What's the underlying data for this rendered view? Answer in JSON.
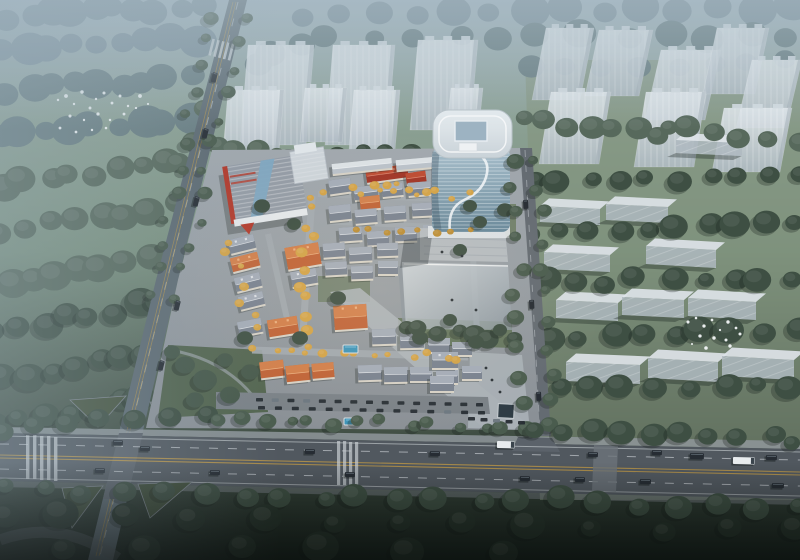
{
  "meta": {
    "title": "Aerial architectural rendering of a mixed-use development with glass office tower, low-rise villa district, ghost massing buildings, forest and road intersection",
    "render_type": "birdseye-3d-render",
    "visible_text": "none"
  },
  "palette": {
    "fogTree": "#7b8f99",
    "fogTree2": "#697e82",
    "midTree": "#57695c",
    "darkTree": "#3e4f43",
    "deepTree": "#29362d",
    "roadTree": "#4a5c4e",
    "parkTree": "#46584a",
    "autumn": "#d2a247",
    "autumn2": "#bb8c34",
    "asphalt": "#51585f",
    "asphaltLight": "#5b626a",
    "sidewalk": "#8f969b",
    "laneYellow": "#bd9747",
    "laneWhite": "#d6dbdf",
    "ghost": "#b9c3cb",
    "ghostTop": "#dde3e8",
    "ghostShade": "#9fabb4",
    "glass": "#7e9cb0",
    "glassLight": "#a9c0cd",
    "towerCap": "#dee5e9",
    "roofGray": "#78818f",
    "roofGrayLight": "#a7afbb",
    "roofOrange": "#bf6236",
    "roofOrangeLight": "#d3824d",
    "roofRed": "#a03425",
    "roofRedLight": "#bf4c33",
    "slabRoof": "#b9c1c9",
    "slabRoofLight": "#dfe4e8",
    "wall": "#d6d1c6",
    "paving": "#9ba2a9",
    "pavingLight": "#b3b9be",
    "lawn": "#66785c",
    "parkGreen": "#52644f",
    "pool": "#3c93b8",
    "carDark": "#262c33",
    "carWhite": "#e8ecee",
    "red": "#b2392a",
    "bird": "#f2f6f7",
    "shadow": "#141d19"
  },
  "scene": {
    "belts": [
      [
        10,
        16,
        200,
        6,
        10,
        15,
        "fogTree",
        "back"
      ],
      [
        0,
        52,
        198,
        40,
        9,
        15,
        "fogTree",
        "back"
      ],
      [
        8,
        92,
        190,
        76,
        9,
        14,
        "fogTree2",
        "back"
      ],
      [
        0,
        138,
        188,
        118,
        9,
        15,
        "fogTree2",
        "back"
      ],
      [
        4,
        184,
        182,
        160,
        9,
        14,
        "midTree",
        "back"
      ],
      [
        0,
        232,
        176,
        206,
        8,
        15,
        "midTree",
        "back"
      ],
      [
        8,
        282,
        168,
        256,
        8,
        14,
        "midTree",
        "back"
      ],
      [
        0,
        330,
        158,
        302,
        8,
        14,
        "darkTree",
        "back"
      ],
      [
        6,
        378,
        148,
        352,
        7,
        13,
        "darkTree",
        "back"
      ],
      [
        0,
        424,
        140,
        398,
        7,
        12,
        "darkTree",
        "back"
      ],
      [
        300,
        14,
        795,
        6,
        14,
        15,
        "fogTree",
        "back"
      ],
      [
        330,
        40,
        792,
        34,
        12,
        13,
        "fogTree2",
        "back"
      ],
      [
        252,
        66,
        298,
        40,
        3,
        12,
        "fogTree2",
        "back"
      ],
      [
        530,
        70,
        790,
        60,
        8,
        12,
        "fogTree2",
        "back"
      ],
      [
        214,
        150,
        332,
        158,
        7,
        10,
        "midTree",
        "mid"
      ],
      [
        340,
        152,
        470,
        158,
        7,
        9,
        "darkTree",
        "mid"
      ],
      [
        520,
        120,
        660,
        132,
        7,
        11,
        "midTree",
        "mid"
      ],
      [
        665,
        128,
        795,
        140,
        6,
        11,
        "midTree",
        "mid"
      ],
      [
        532,
        182,
        795,
        175,
        10,
        11,
        "darkTree",
        "mid"
      ],
      [
        536,
        232,
        795,
        224,
        10,
        12,
        "darkTree",
        "mid"
      ],
      [
        544,
        282,
        795,
        276,
        9,
        11,
        "darkTree",
        "mid"
      ],
      [
        552,
        336,
        795,
        330,
        9,
        12,
        "darkTree",
        "mid"
      ],
      [
        558,
        390,
        795,
        386,
        8,
        11,
        "darkTree",
        "mid"
      ],
      [
        205,
        108,
        198,
        138,
        2,
        10,
        "midTree",
        "mid"
      ],
      [
        400,
        330,
        508,
        338,
        7,
        9,
        "darkTree",
        "site"
      ],
      [
        312,
        196,
        303,
        344,
        11,
        5,
        "autumn",
        "site"
      ],
      [
        330,
        190,
        468,
        196,
        9,
        4,
        "autumn",
        "site"
      ],
      [
        256,
        352,
        462,
        357,
        13,
        4,
        "autumn",
        "site"
      ],
      [
        224,
        240,
        256,
        330,
        7,
        4,
        "autumn",
        "site"
      ],
      [
        352,
        228,
        468,
        234,
        8,
        4,
        "autumn2",
        "site"
      ],
      [
        368,
        184,
        430,
        188,
        5,
        4,
        "autumn",
        "site"
      ],
      [
        216,
        14,
        150,
        296,
        12,
        6,
        "roadTree",
        "front"
      ],
      [
        244,
        16,
        178,
        296,
        12,
        6,
        "roadTree",
        "front"
      ],
      [
        512,
        160,
        526,
        428,
        11,
        7,
        "roadTree",
        "front"
      ],
      [
        540,
        160,
        556,
        428,
        11,
        7,
        "roadTree",
        "front"
      ],
      [
        0,
        428,
        205,
        416,
        7,
        10,
        "darkTree",
        "front"
      ],
      [
        214,
        420,
        530,
        426,
        14,
        7,
        "roadTree",
        "front"
      ],
      [
        536,
        428,
        798,
        440,
        10,
        11,
        "darkTree",
        "front"
      ],
      [
        4,
        490,
        796,
        506,
        21,
        11,
        "darkTree",
        "front"
      ],
      [
        0,
        516,
        790,
        532,
        13,
        14,
        "deepTree",
        "front"
      ],
      [
        60,
        548,
        500,
        552,
        6,
        16,
        "deepTree",
        "front"
      ]
    ],
    "site_trees": [
      [
        262,
        206,
        8,
        "darkTree"
      ],
      [
        294,
        224,
        7,
        "darkTree"
      ],
      [
        338,
        298,
        8,
        "darkTree"
      ],
      [
        300,
        338,
        8,
        "darkTree"
      ],
      [
        245,
        338,
        8,
        "darkTree"
      ],
      [
        420,
        338,
        8,
        "darkTree"
      ],
      [
        450,
        320,
        7,
        "darkTree"
      ],
      [
        476,
        342,
        8,
        "darkTree"
      ],
      [
        500,
        330,
        7,
        "darkTree"
      ],
      [
        460,
        250,
        7,
        "darkTree"
      ],
      [
        480,
        222,
        7,
        "darkTree"
      ],
      [
        505,
        210,
        8,
        "darkTree"
      ],
      [
        470,
        206,
        7,
        "darkTree"
      ],
      [
        185,
        365,
        10,
        "parkTree"
      ],
      [
        205,
        380,
        12,
        "parkTree"
      ],
      [
        230,
        395,
        10,
        "parkTree"
      ],
      [
        195,
        400,
        9,
        "parkTree"
      ],
      [
        250,
        372,
        9,
        "parkTree"
      ],
      [
        225,
        360,
        8,
        "parkTree"
      ],
      [
        172,
        352,
        8,
        "parkTree"
      ]
    ],
    "ghost_towers": [
      [
        240,
        45,
        66,
        100,
        8
      ],
      [
        325,
        45,
        62,
        100,
        8
      ],
      [
        410,
        40,
        60,
        90,
        8
      ],
      [
        222,
        90,
        56,
        76,
        6
      ],
      [
        300,
        88,
        42,
        54,
        5
      ],
      [
        348,
        90,
        46,
        72,
        6
      ],
      [
        446,
        88,
        32,
        48,
        5
      ],
      [
        532,
        28,
        48,
        72,
        14
      ],
      [
        585,
        30,
        54,
        66,
        14
      ],
      [
        645,
        50,
        60,
        70,
        16
      ],
      [
        703,
        28,
        52,
        66,
        14
      ],
      [
        736,
        60,
        50,
        68,
        16
      ],
      [
        539,
        92,
        60,
        72,
        12
      ],
      [
        634,
        92,
        60,
        75,
        12
      ],
      [
        712,
        108,
        68,
        64,
        12
      ]
    ],
    "ghost_slabs": [
      [
        540,
        206,
        60,
        16,
        3,
        9
      ],
      [
        606,
        204,
        62,
        16,
        3,
        9
      ],
      [
        544,
        252,
        66,
        17,
        3,
        9
      ],
      [
        646,
        246,
        70,
        18,
        4,
        9
      ],
      [
        556,
        300,
        62,
        18,
        3,
        10
      ],
      [
        622,
        297,
        62,
        18,
        3,
        10
      ],
      [
        688,
        298,
        68,
        18,
        4,
        10
      ],
      [
        566,
        362,
        74,
        19,
        3,
        10
      ],
      [
        648,
        358,
        70,
        20,
        4,
        10
      ],
      [
        722,
        356,
        72,
        20,
        4,
        10
      ],
      [
        676,
        140,
        66,
        13,
        3,
        8
      ]
    ],
    "villas": [
      [
        366,
        167,
        42,
        13,
        -8,
        "r"
      ],
      [
        406,
        172,
        20,
        11,
        -8,
        "r"
      ],
      [
        332,
        161,
        60,
        10,
        -6,
        "s"
      ],
      [
        396,
        158,
        52,
        10,
        -5,
        "s"
      ],
      [
        329,
        179,
        22,
        14,
        -8,
        "g"
      ],
      [
        354,
        186,
        24,
        13,
        -7,
        "g"
      ],
      [
        382,
        184,
        21,
        12,
        -6,
        "g"
      ],
      [
        408,
        182,
        23,
        13,
        -5,
        "g"
      ],
      [
        435,
        186,
        20,
        12,
        -4,
        "g"
      ],
      [
        360,
        196,
        20,
        13,
        -6,
        "o"
      ],
      [
        329,
        205,
        22,
        15,
        -6,
        "g"
      ],
      [
        355,
        209,
        22,
        14,
        -5,
        "g"
      ],
      [
        384,
        206,
        22,
        14,
        -4,
        "g"
      ],
      [
        412,
        203,
        20,
        13,
        -3,
        "g"
      ],
      [
        440,
        207,
        21,
        13,
        -2,
        "g"
      ],
      [
        464,
        203,
        18,
        12,
        0,
        "g"
      ],
      [
        339,
        227,
        23,
        14,
        -4,
        "g"
      ],
      [
        367,
        231,
        22,
        14,
        -3,
        "g"
      ],
      [
        395,
        227,
        22,
        14,
        -2,
        "g"
      ],
      [
        423,
        225,
        20,
        13,
        0,
        "g"
      ],
      [
        450,
        227,
        20,
        13,
        0,
        "g"
      ],
      [
        286,
        245,
        34,
        22,
        -10,
        "o"
      ],
      [
        291,
        270,
        26,
        15,
        -10,
        "g"
      ],
      [
        229,
        237,
        26,
        14,
        -14,
        "g"
      ],
      [
        231,
        255,
        28,
        14,
        -14,
        "o"
      ],
      [
        235,
        275,
        26,
        14,
        -14,
        "g"
      ],
      [
        239,
        294,
        25,
        13,
        -14,
        "g"
      ],
      [
        323,
        243,
        22,
        14,
        -4,
        "g"
      ],
      [
        349,
        247,
        23,
        14,
        -3,
        "g"
      ],
      [
        377,
        243,
        21,
        13,
        -2,
        "g"
      ],
      [
        325,
        262,
        22,
        13,
        -3,
        "g"
      ],
      [
        351,
        266,
        22,
        13,
        -2,
        "g"
      ],
      [
        378,
        261,
        20,
        13,
        0,
        "g"
      ],
      [
        268,
        318,
        30,
        17,
        -9,
        "o"
      ],
      [
        238,
        320,
        24,
        14,
        -11,
        "g"
      ],
      [
        334,
        305,
        33,
        24,
        -4,
        "o"
      ],
      [
        372,
        329,
        24,
        15,
        -2,
        "g"
      ],
      [
        400,
        333,
        24,
        15,
        -1,
        "g"
      ],
      [
        428,
        338,
        22,
        14,
        0,
        "g"
      ],
      [
        452,
        342,
        20,
        13,
        0,
        "g"
      ],
      [
        260,
        361,
        24,
        16,
        -7,
        "o"
      ],
      [
        286,
        365,
        24,
        16,
        -6,
        "o"
      ],
      [
        312,
        363,
        22,
        15,
        -5,
        "o"
      ],
      [
        358,
        365,
        24,
        15,
        -2,
        "g"
      ],
      [
        384,
        367,
        24,
        15,
        -1,
        "g"
      ],
      [
        410,
        367,
        22,
        14,
        0,
        "g"
      ],
      [
        436,
        369,
        22,
        14,
        0,
        "g"
      ],
      [
        462,
        366,
        20,
        13,
        0,
        "g"
      ],
      [
        432,
        352,
        26,
        16,
        0,
        "g"
      ],
      [
        430,
        376,
        24,
        15,
        0,
        "g"
      ]
    ],
    "pools": [
      [
        343,
        345,
        15,
        8
      ],
      [
        344,
        418,
        11,
        7
      ]
    ],
    "cars_main": [
      [
        113,
        440,
        10,
        5,
        "d"
      ],
      [
        140,
        446,
        10,
        5,
        "d"
      ],
      [
        305,
        449,
        10,
        5,
        "d"
      ],
      [
        430,
        451,
        10,
        5,
        "d"
      ],
      [
        497,
        441,
        18,
        7,
        "w"
      ],
      [
        588,
        452,
        10,
        5,
        "d"
      ],
      [
        652,
        450,
        10,
        5,
        "d"
      ],
      [
        690,
        453,
        14,
        6,
        "d"
      ],
      [
        766,
        455,
        11,
        5,
        "d"
      ],
      [
        733,
        457,
        22,
        7,
        "w"
      ],
      [
        95,
        468,
        10,
        5,
        "d"
      ],
      [
        210,
        470,
        10,
        5,
        "d"
      ],
      [
        345,
        472,
        10,
        5,
        "d"
      ],
      [
        520,
        476,
        10,
        5,
        "d"
      ],
      [
        575,
        477,
        10,
        5,
        "d"
      ],
      [
        640,
        479,
        11,
        5,
        "d"
      ],
      [
        772,
        483,
        12,
        5,
        "d"
      ]
    ],
    "cars_diag": [
      [
        213,
        72
      ],
      [
        204,
        128
      ],
      [
        195,
        196
      ],
      [
        176,
        300
      ],
      [
        160,
        360
      ]
    ],
    "cars_east": [
      [
        523,
        200
      ],
      [
        529,
        300
      ],
      [
        536,
        392
      ]
    ],
    "parked_rows": [
      [
        256,
        398,
        476,
        403,
        15
      ],
      [
        258,
        406,
        478,
        411,
        14
      ],
      [
        468,
        417,
        518,
        421,
        5
      ]
    ],
    "birds_left": [
      [
        58,
        100
      ],
      [
        66,
        96
      ],
      [
        74,
        104
      ],
      [
        82,
        92
      ],
      [
        90,
        108
      ],
      [
        96,
        99
      ],
      [
        104,
        93
      ],
      [
        112,
        103
      ],
      [
        120,
        96
      ],
      [
        128,
        106
      ],
      [
        70,
        116
      ],
      [
        84,
        120
      ],
      [
        98,
        114
      ],
      [
        110,
        120
      ],
      [
        124,
        114
      ],
      [
        136,
        108
      ],
      [
        60,
        128
      ],
      [
        76,
        132
      ],
      [
        92,
        130
      ],
      [
        106,
        128
      ],
      [
        140,
        96
      ],
      [
        148,
        104
      ]
    ],
    "birds_right": [
      [
        688,
        322
      ],
      [
        696,
        318
      ],
      [
        704,
        326
      ],
      [
        712,
        320
      ],
      [
        720,
        330
      ],
      [
        728,
        322
      ],
      [
        736,
        328
      ],
      [
        700,
        336
      ],
      [
        714,
        338
      ],
      [
        726,
        340
      ],
      [
        740,
        334
      ],
      [
        692,
        344
      ],
      [
        706,
        348
      ],
      [
        730,
        346
      ]
    ],
    "figures": [
      [
        486,
        368
      ],
      [
        492,
        380
      ],
      [
        500,
        392
      ],
      [
        452,
        300
      ],
      [
        442,
        252
      ],
      [
        462,
        256
      ],
      [
        476,
        310
      ]
    ]
  }
}
